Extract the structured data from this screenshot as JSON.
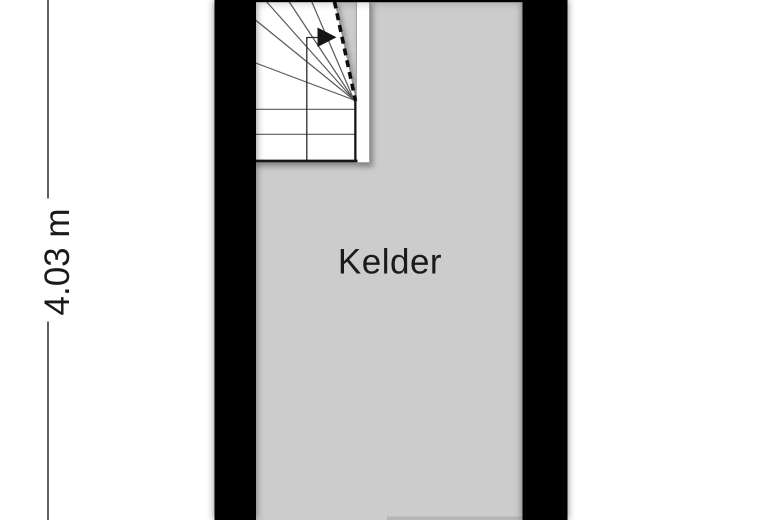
{
  "room": {
    "label": "Kelder"
  },
  "dimension": {
    "label": "4.03 m",
    "orientation": "vertical"
  },
  "icons": {
    "stair_direction_arrow": "filled-right-triangle"
  },
  "colors": {
    "background": "#ffffff",
    "floor": "#cccccc",
    "wall": "#000000",
    "stair_fill": "#ffffff",
    "stair_line": "#5a5a5a",
    "outline": "#141414",
    "text": "#1a1a1a",
    "dim_line": "#3a3a3a",
    "fragment": "#b5b5b5"
  }
}
